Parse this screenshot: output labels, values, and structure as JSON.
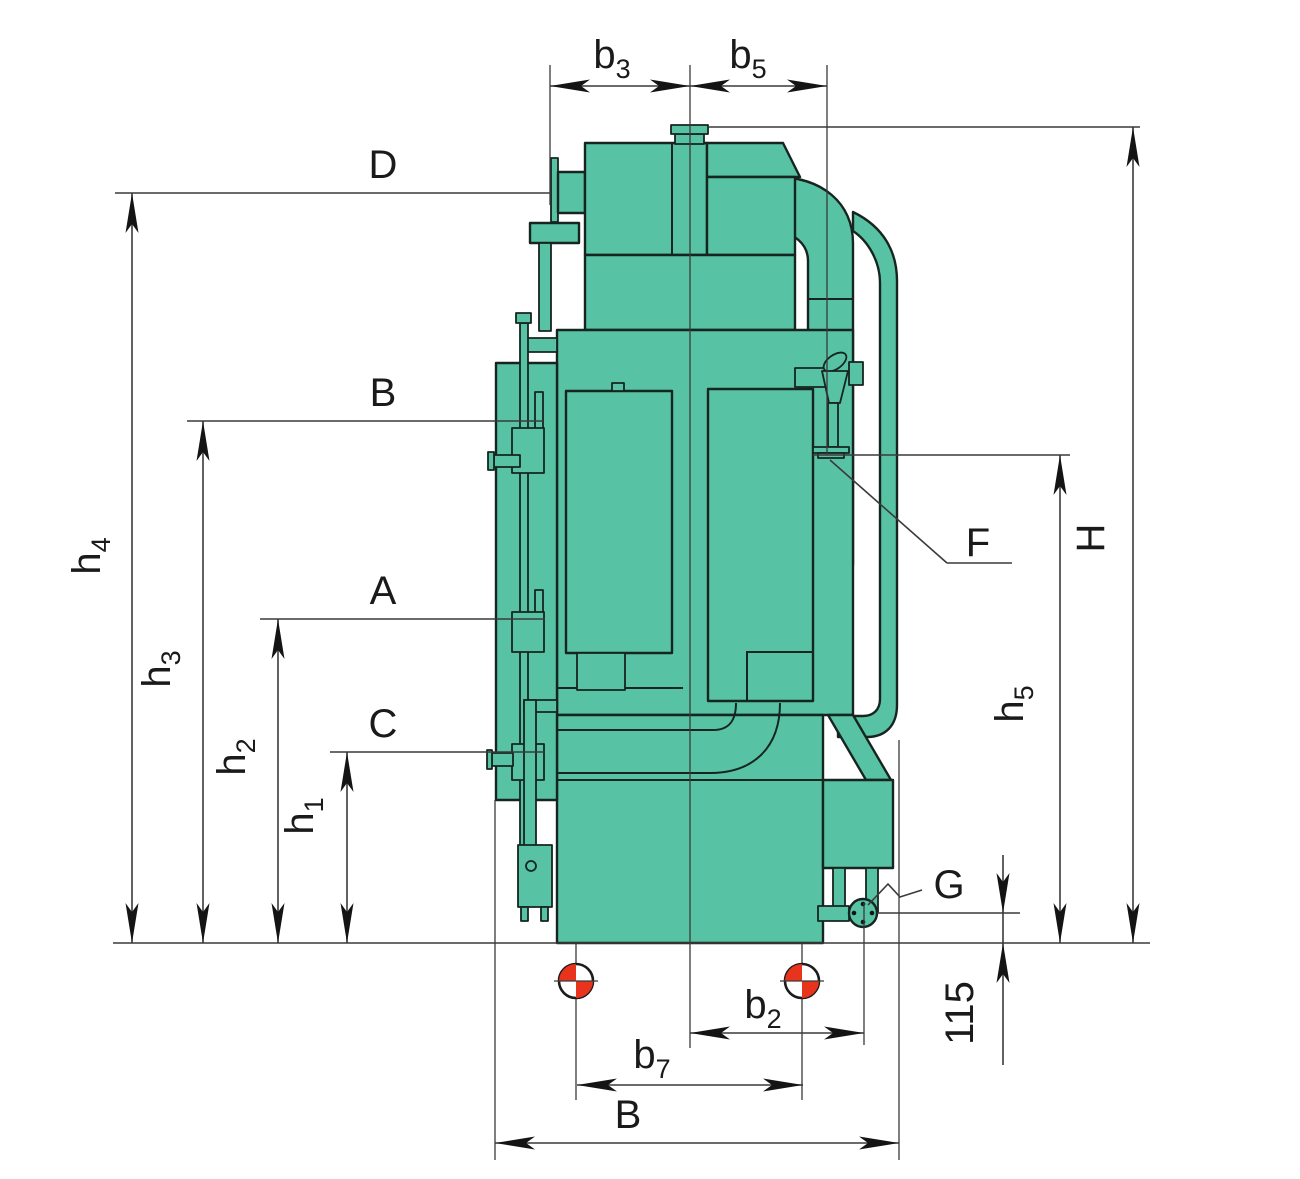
{
  "labels": {
    "b3": {
      "base": "b",
      "sub": "3"
    },
    "b5": {
      "base": "b",
      "sub": "5"
    },
    "D": "D",
    "B_left": "B",
    "A": "A",
    "C": "C",
    "h4": {
      "base": "h",
      "sub": "4"
    },
    "h3": {
      "base": "h",
      "sub": "3"
    },
    "h2": {
      "base": "h",
      "sub": "2"
    },
    "h1": {
      "base": "h",
      "sub": "1"
    },
    "H": "H",
    "h5": {
      "base": "h",
      "sub": "5"
    },
    "F": "F",
    "G": "G",
    "dim115": "115",
    "b2": {
      "base": "b",
      "sub": "2"
    },
    "b7": {
      "base": "b",
      "sub": "7"
    },
    "B_bottom": "B"
  },
  "colors": {
    "machine_fill": "#57C3A4",
    "outline": "#16251f",
    "dimension": "#3a3a3a",
    "arrow": "#141414",
    "datum_red": "#e8341c",
    "background": "#ffffff",
    "label": "#1a1a1a"
  },
  "icons": {
    "datum_target": "circle with red opposite quadrants (center-of-gravity mark)",
    "flange": "bolted flange circle"
  }
}
